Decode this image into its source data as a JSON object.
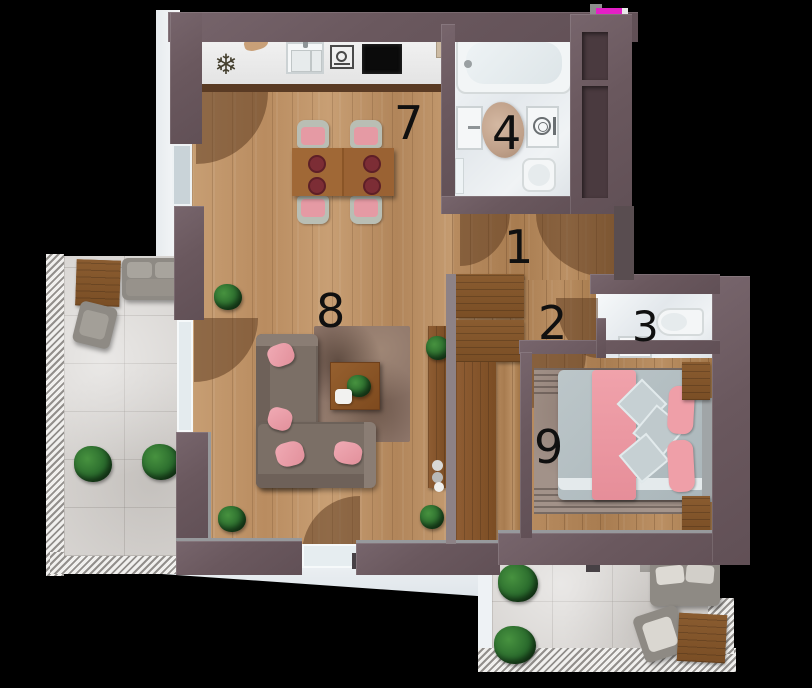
{
  "scene": {
    "type": "apartment-floor-plan-top-down-render",
    "background": "#000000"
  },
  "room_labels": [
    {
      "num": "7",
      "room": "kitchen-dining"
    },
    {
      "num": "8",
      "room": "living-room"
    },
    {
      "num": "1",
      "room": "hallway"
    },
    {
      "num": "2",
      "room": "corridor"
    },
    {
      "num": "3",
      "room": "wc"
    },
    {
      "num": "4",
      "room": "bathroom"
    },
    {
      "num": "9",
      "room": "bedroom"
    }
  ],
  "glyphs": {
    "fridge_snowflake": "❄"
  },
  "icons": {
    "fridge": "snowflake-icon",
    "oven": "oven-icon",
    "cooktop": "cooktop-panel",
    "sink": "kitchen-sink",
    "washer": "washing-machine-icon"
  },
  "palette": {
    "background": "#000000",
    "wall": "#6a585e",
    "wall_recess": "#4a3a3f",
    "wood_floor": "#c49c70",
    "wood_furniture": "#82552b",
    "terrace_tile": "#d8d5d2",
    "bathroom_floor": "#e9edf0",
    "sofa_grey_brown": "#7b6f66",
    "pink_accent": "#e89aa4",
    "bed_linen_grey": "#b4bfc2",
    "plant_green": "#2c6e31",
    "rug_living": "#8d7569",
    "rug_bedroom": "#a29289",
    "artifact_magenta": "#e320c6"
  }
}
